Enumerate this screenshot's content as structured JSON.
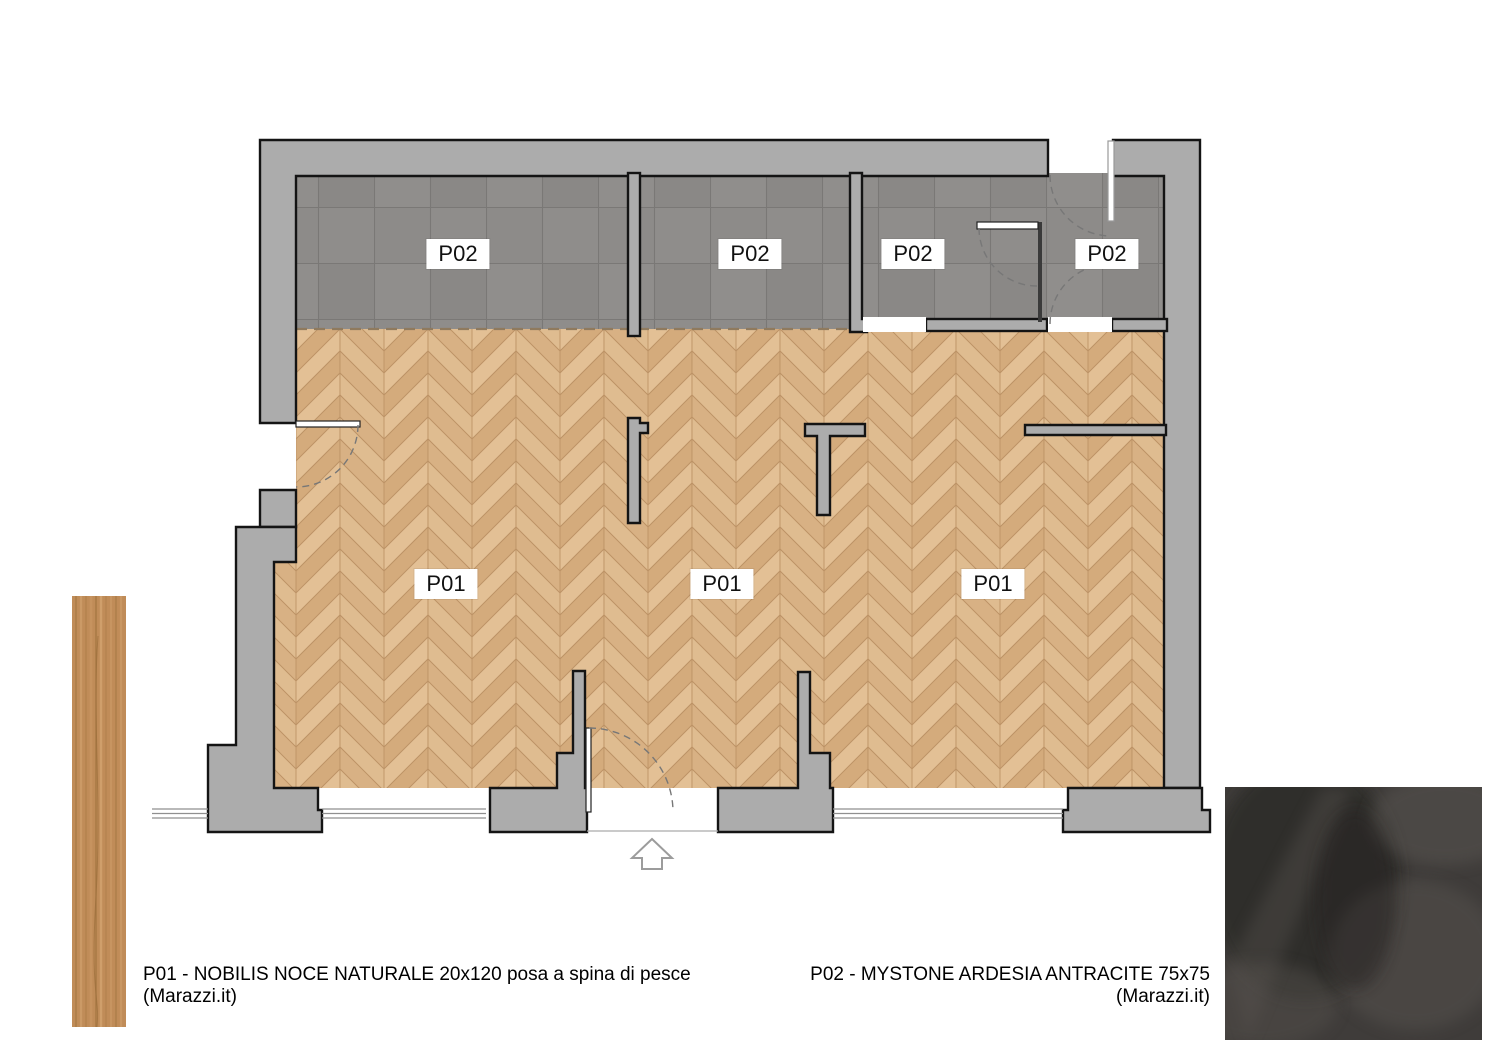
{
  "plan": {
    "p02_labels": [
      "P02",
      "P02",
      "P02",
      "P02"
    ],
    "p01_labels": [
      "P01",
      "P01",
      "P01"
    ]
  },
  "legend": {
    "p01_line1": "P01 - NOBILIS NOCE NATURALE 20x120 posa a spina di pesce",
    "p01_line2": "(Marazzi.it)",
    "p02_line1": "P02 - MYSTONE ARDESIA ANTRACITE 75x75",
    "p02_line2": "(Marazzi.it)"
  },
  "colors": {
    "wall_fill": "#acacac",
    "wall_outline": "#141414",
    "tile_grey": "#8d8b89",
    "tile_grout": "#7a7876",
    "wood_base": "#dcb88a",
    "wood_light": "#e3c095",
    "wood_dark": "#d4ab7c",
    "wood_joint": "#bd9366",
    "plank_sample": "#c08c58",
    "slate_sample": "#3f3c3a",
    "label_bg": "#ffffff",
    "text": "#000000"
  },
  "icons": {
    "entrance_arrow": "up-arrow-outline"
  }
}
